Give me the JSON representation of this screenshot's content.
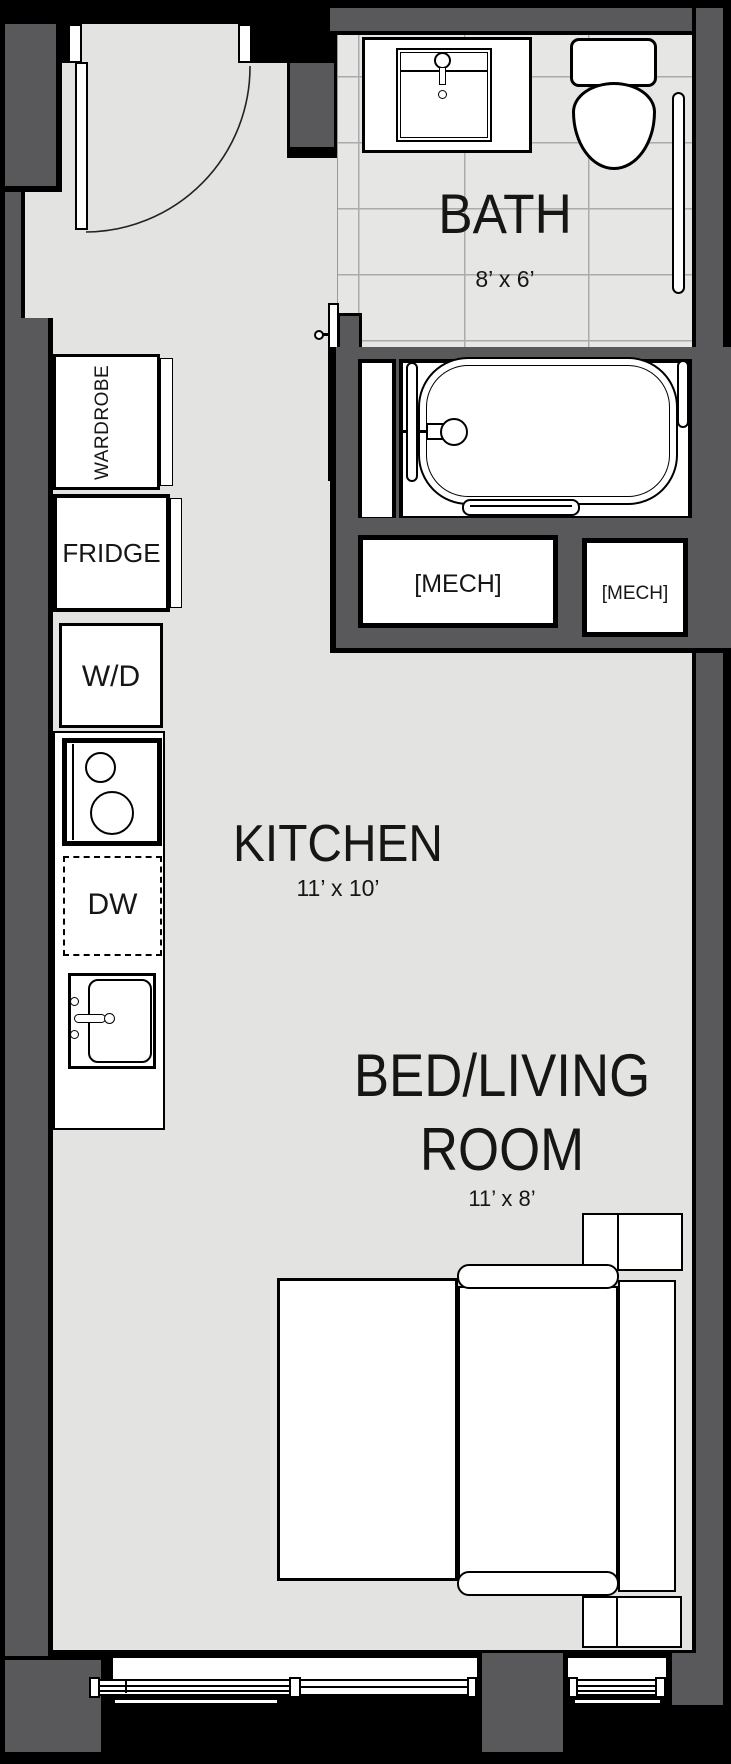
{
  "plan_title": "Studio apartment floor plan",
  "colors": {
    "wall": "#59595b",
    "floor": "#e3e3e2",
    "tile": "#e6e6e5",
    "tile_grid": "#ababab",
    "fixture": "#ffffff",
    "outline": "#000000",
    "text": "#161616"
  },
  "rooms": {
    "bath": {
      "name": "BATH",
      "dims": "8’ x 6’"
    },
    "kitchen": {
      "name": "KITCHEN",
      "dims": "11’ x 10’"
    },
    "bed_living": {
      "line1": "BED/LIVING",
      "line2": "ROOM",
      "dims": "11’ x 8’"
    }
  },
  "fixtures": {
    "wardrobe": "WARDROBE",
    "fridge": "FRIDGE",
    "washer_dryer": "W/D",
    "dishwasher": "DW"
  },
  "mech": {
    "large": "[MECH]",
    "small": "[MECH]"
  },
  "icons": [
    "entry-door-icon",
    "door-swing-arc-icon",
    "bath-door-icon",
    "vanity-sink-icon",
    "toilet-icon",
    "grab-bar-icon",
    "bathtub-icon",
    "tub-faucet-icon",
    "stove-burners-icon",
    "kitchen-sink-icon",
    "bed-icon",
    "sofa-icon",
    "window-icon"
  ]
}
